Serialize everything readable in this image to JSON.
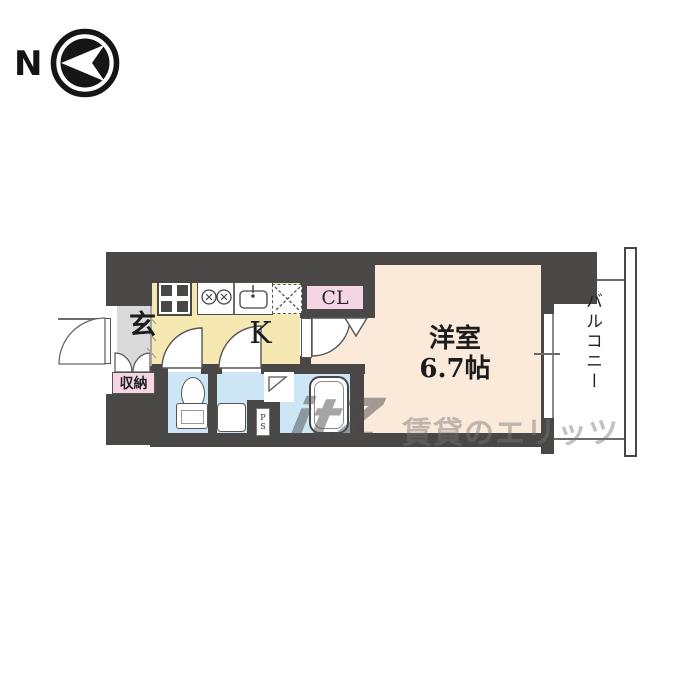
{
  "compass": {
    "north_label": "N"
  },
  "rooms": {
    "entrance": {
      "label": "玄"
    },
    "storage": {
      "label": "収納"
    },
    "kitchen": {
      "label": "K"
    },
    "closet": {
      "label": "CL"
    },
    "western_room": {
      "label": "洋室",
      "size": "6.7帖"
    },
    "balcony": {
      "label": "バルコニー"
    },
    "pipe_space": {
      "label": "PS"
    }
  },
  "watermark": {
    "logo": "itZ",
    "text": "賃貸のエリッツ"
  },
  "colors": {
    "wall": "#4a4846",
    "room_cream": "#fbe9d9",
    "kitchen_yellow": "#f5e8b2",
    "wet_blue": "#cde6f5",
    "accent_pink": "#f5d5e3",
    "entrance_gray": "#dadada",
    "watermark_gray": "#767676"
  }
}
